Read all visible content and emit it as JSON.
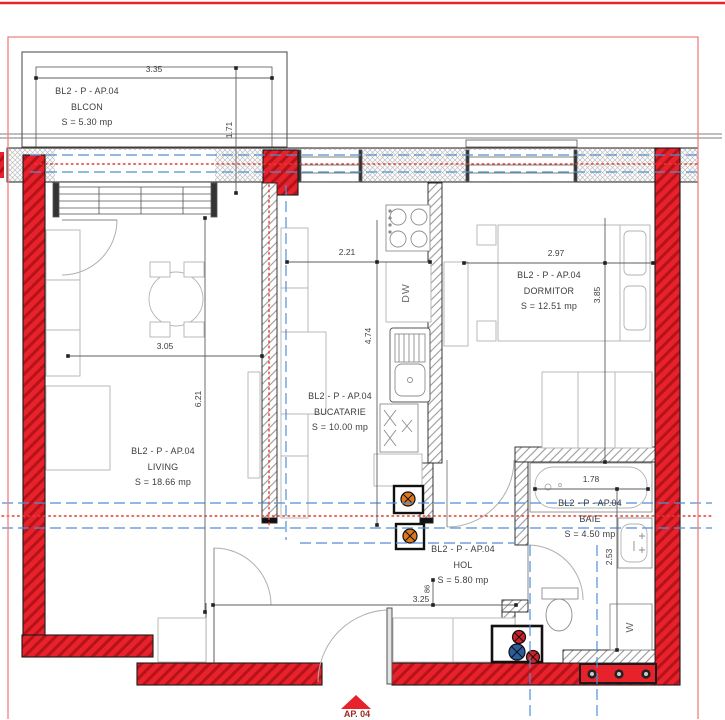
{
  "plan": {
    "unit_marker": "AP. 04",
    "rooms": [
      {
        "code": "BL2 - P - AP.04",
        "name": "BLCON",
        "area": "S = 5.30 mp"
      },
      {
        "code": "BL2 - P - AP.04",
        "name": "LIVING",
        "area": "S = 18.66 mp"
      },
      {
        "code": "BL2 - P - AP.04",
        "name": "BUCATARIE",
        "area": "S = 10.00 mp"
      },
      {
        "code": "BL2 - P - AP.04",
        "name": "DORMITOR",
        "area": "S = 12.51 mp"
      },
      {
        "code": "BL2 - P - AP.04",
        "name": "BAIE",
        "area": "S = 4.50 mp"
      },
      {
        "code": "BL2 - P - AP.04",
        "name": "HOL",
        "area": "S = 5.80 mp"
      }
    ],
    "dimensions": {
      "balcony_width": "3.35",
      "balcony_depth": "1.71",
      "living_width": "3.05",
      "living_length": "6.21",
      "kitchen_width": "2.21",
      "kitchen_length": "4.74",
      "bedroom_width": "2.97",
      "bedroom_length": "3.85",
      "bath_width": "1.78",
      "bath_length": "2.53",
      "hall_width": "3.25",
      "hall_nib": "86"
    },
    "appliances": {
      "dishwasher": "DW",
      "washing_machine": "W"
    },
    "colors": {
      "structural_red": "#e8222b",
      "hatch_red": "#b5121b",
      "axis_blue": "#4f8fd2",
      "axis_red": "#e23d2e",
      "boundary_pink": "#f28080"
    }
  }
}
